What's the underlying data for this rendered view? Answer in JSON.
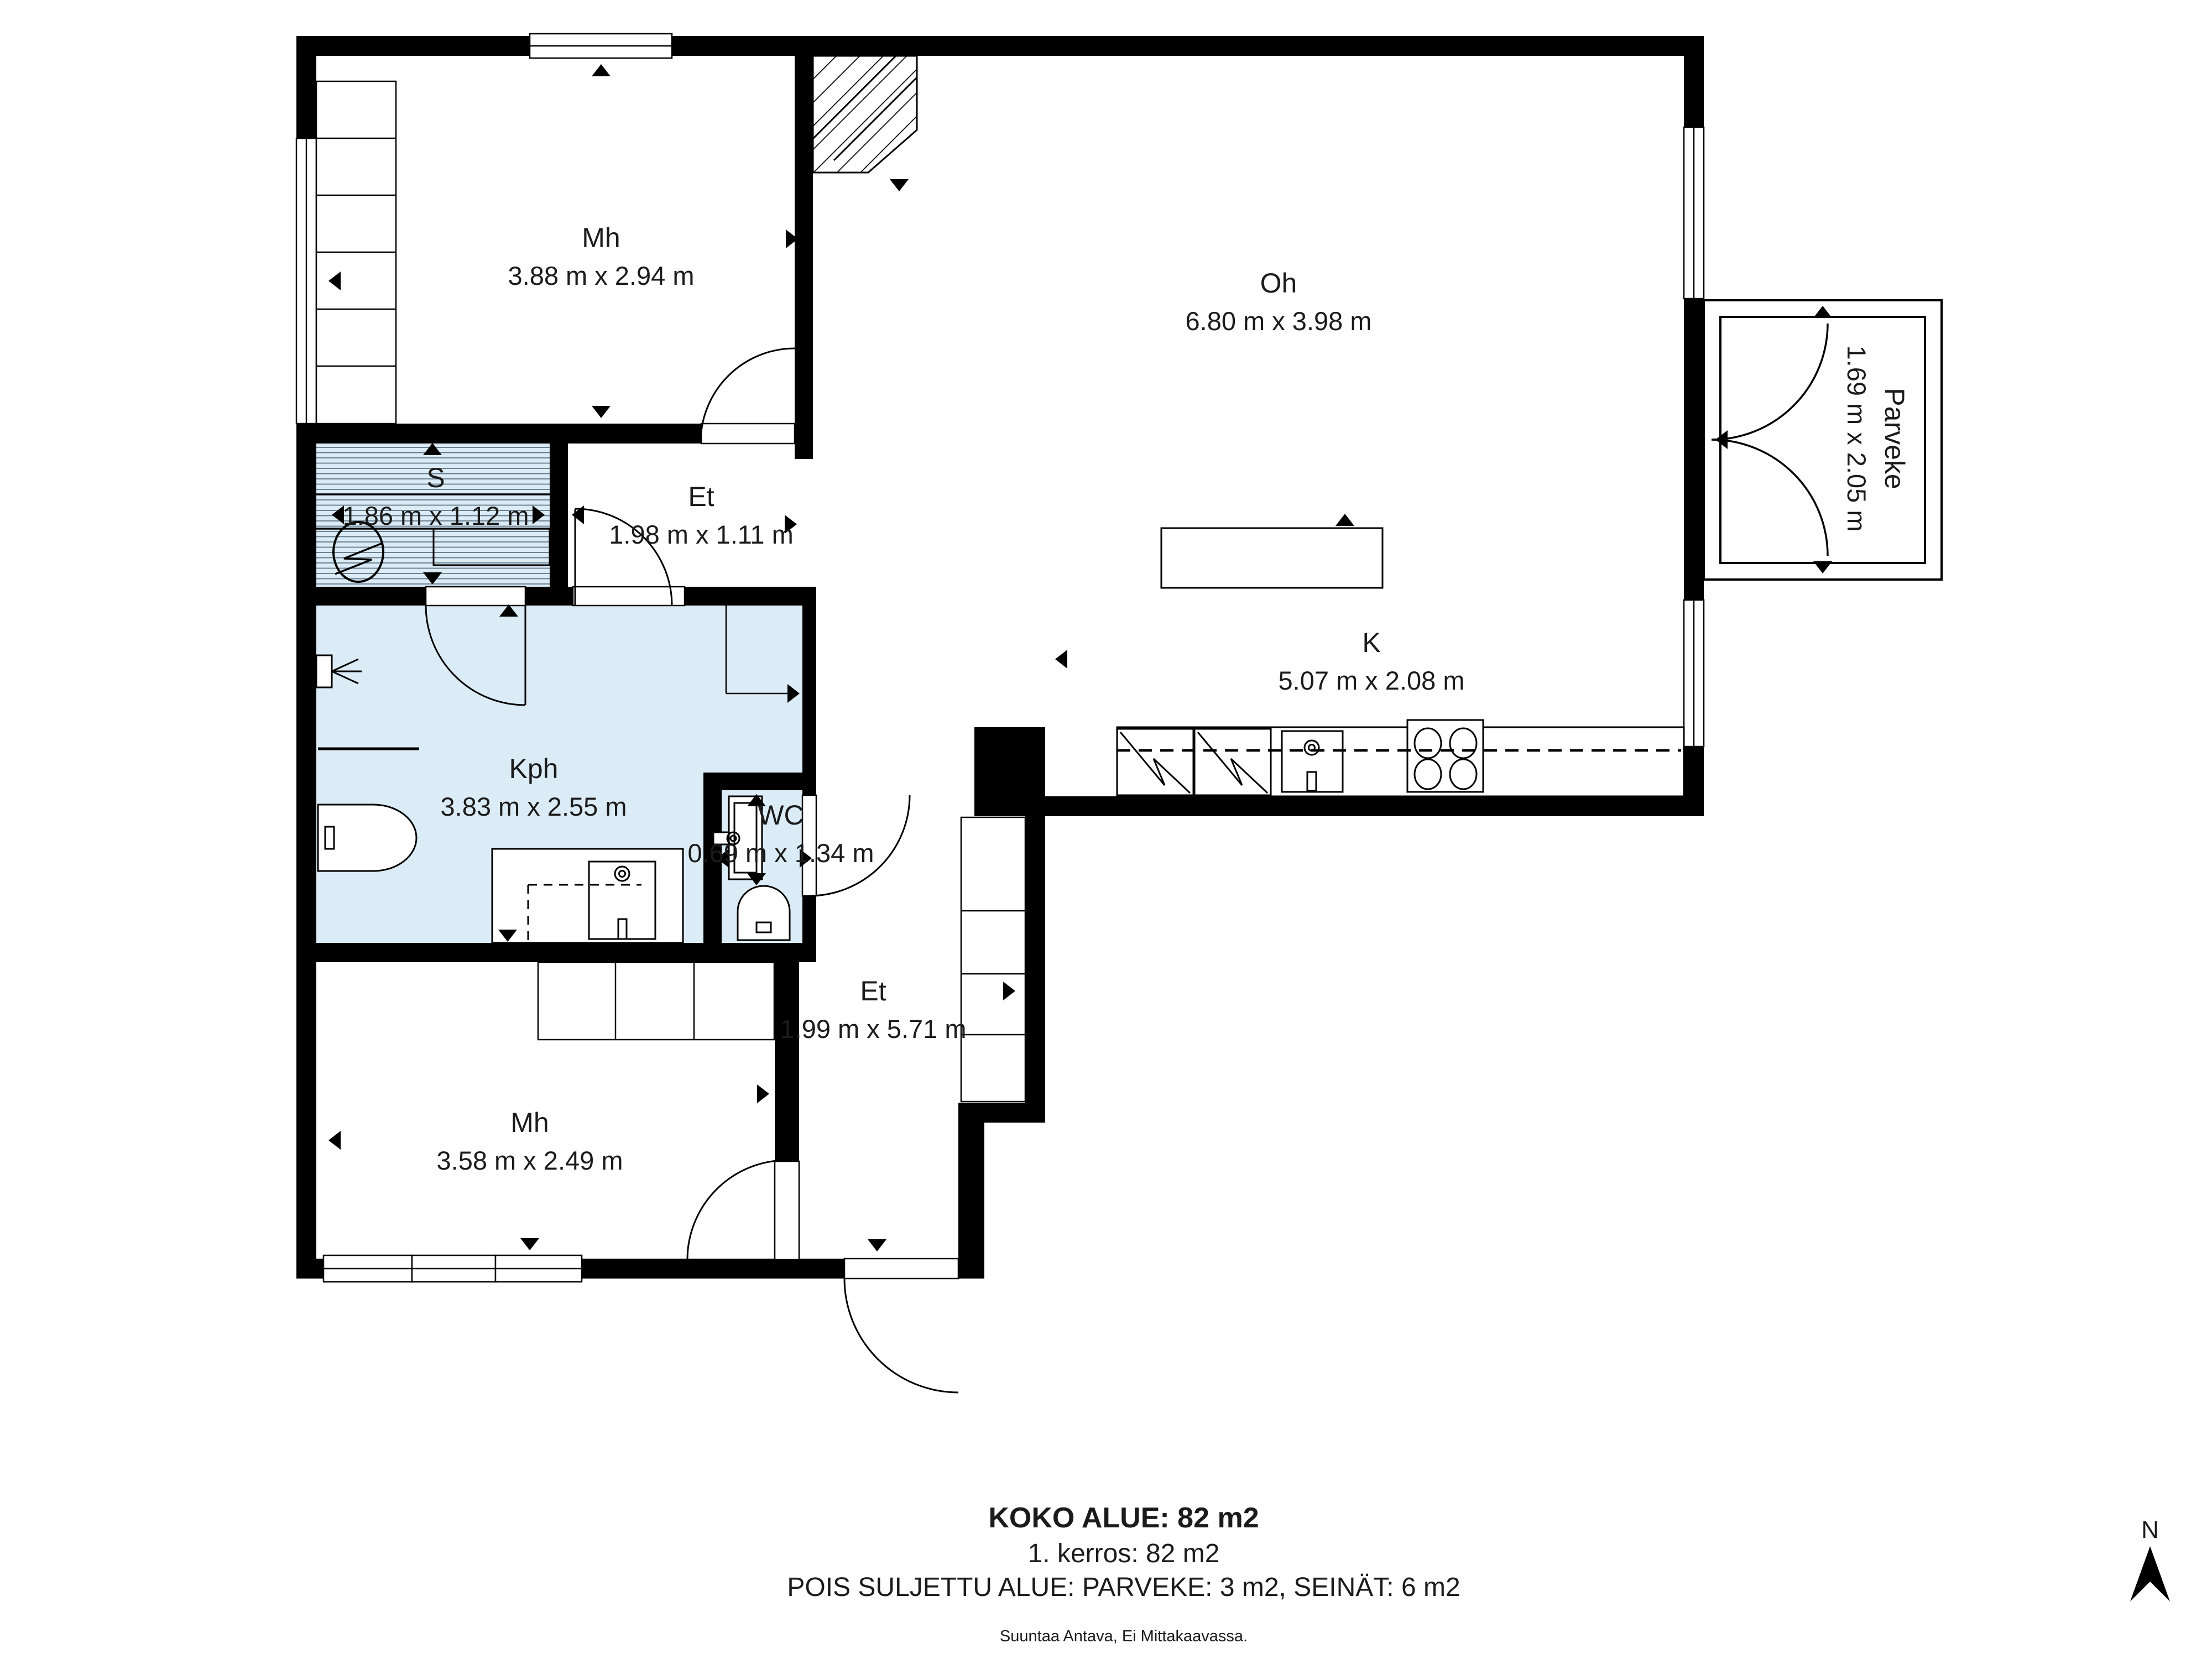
{
  "plan": {
    "rooms": [
      {
        "id": "mh1",
        "name": "Mh",
        "dims": "3.88 m x 2.94 m"
      },
      {
        "id": "oh",
        "name": "Oh",
        "dims": "6.80 m x 3.98 m"
      },
      {
        "id": "s",
        "name": "S",
        "dims": "1.86 m x 1.12 m"
      },
      {
        "id": "et-upper",
        "name": "Et",
        "dims": "1.98 m x 1.11 m"
      },
      {
        "id": "kph",
        "name": "Kph",
        "dims": "3.83 m x 2.55 m"
      },
      {
        "id": "wc",
        "name": "WC",
        "dims": "0.69 m x 1.34 m"
      },
      {
        "id": "k",
        "name": "K",
        "dims": "5.07 m x 2.08 m"
      },
      {
        "id": "et-lower",
        "name": "Et",
        "dims": "1.99 m x 5.71 m"
      },
      {
        "id": "mh2",
        "name": "Mh",
        "dims": "3.58 m x 2.49 m"
      },
      {
        "id": "parveke",
        "name": "Parveke",
        "dims": "1.69 m x 2.05 m"
      }
    ],
    "colors": {
      "wall": "#000000",
      "wet_room": "#dcecf7",
      "floor": "#ffffff"
    }
  },
  "summary": {
    "total_area": "KOKO ALUE: 82 m2",
    "floor": "1. kerros: 82 m2",
    "excluded": "POIS SULJETTU ALUE: PARVEKE: 3 m2, SEINÄT: 6 m2",
    "disclaimer": "Suuntaa Antava, Ei Mittakaavassa."
  },
  "compass": {
    "north_label": "N"
  }
}
